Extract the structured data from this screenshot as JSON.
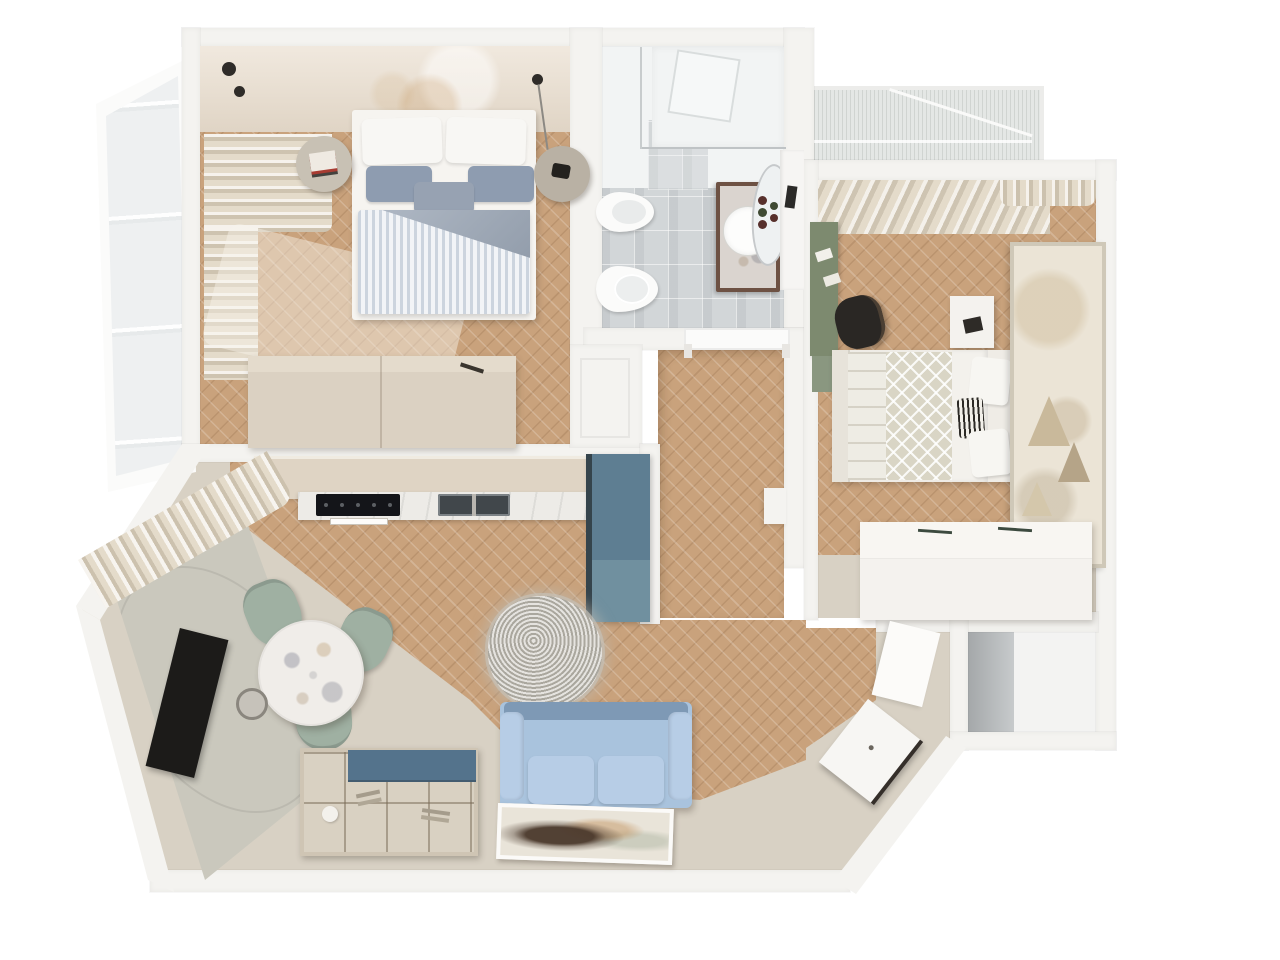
{
  "scene": {
    "type": "3d-floor-plan-render",
    "view": "top-down-isometric",
    "subject": "two-bedroom apartment interior visualization",
    "text_on_screen": "none"
  },
  "rooms": [
    {
      "id": "bedroom-1",
      "position": "top-left",
      "floor": "wood-herringbone",
      "furniture": [
        "double-bed-striped-duvet",
        "round-nightstand-left",
        "round-nightstand-right",
        "wardrobe",
        "curtains",
        "open-casement-window",
        "ceiling-spotlights"
      ]
    },
    {
      "id": "bathroom",
      "position": "top-center",
      "floor": "grey-tile",
      "furniture": [
        "shower-tray",
        "glass-partition",
        "bidet",
        "toilet",
        "wood-vanity-round-sink",
        "round-mirror",
        "shelf-unit"
      ]
    },
    {
      "id": "bedroom-2",
      "position": "right",
      "floor": "wood-herringbone",
      "furniture": [
        "single-bed",
        "green-desk",
        "black-chair",
        "white-nightstand",
        "wall-tapestry",
        "white-dresser",
        "curtains"
      ]
    },
    {
      "id": "balcony",
      "position": "top-right",
      "furniture": [
        "glass-balustrade"
      ]
    },
    {
      "id": "hallway",
      "position": "center",
      "floor": "wood-herringbone",
      "furniture": [
        "bathroom-door-frame"
      ]
    },
    {
      "id": "kitchen-living-room",
      "position": "bottom-left",
      "floor": "wood-and-beige",
      "furniture": [
        "kitchen-cabinet-run",
        "cooktop",
        "double-sink",
        "tall-blue-cabinet",
        "round-marble-dining-table",
        "sage-chairs",
        "pendant-lamp",
        "tv-accent-wall",
        "shag-rug",
        "blue-sofa",
        "compartment-organizer",
        "floor-painting",
        "curtains"
      ]
    },
    {
      "id": "entry",
      "position": "bottom-right",
      "furniture": [
        "open-front-door",
        "wall-panel"
      ]
    },
    {
      "id": "storage-closet",
      "position": "bottom-right-corner",
      "furniture": []
    }
  ],
  "palette": {
    "background": "#ffffff",
    "wall": "#f4f3f0",
    "wood_floor": "#c9a27c",
    "beige_floor": "#d8d1c4",
    "tile_floor": "#d2d6d8",
    "shower_white": "#f2f4f4",
    "headboard_wall": "#e9ddcd",
    "curtain": "#e4dbca",
    "sheer": "#f4efe6",
    "bed_linen": "#f6f4f0",
    "pillow_blue": "#8e9cb0",
    "duvet_fold": "#97a3b3",
    "duvet_stripe": "#dfe4eb",
    "nightstand": "#c8c1b4",
    "wardrobe": "#dbd1c2",
    "wardrobe_top": "#e4dbcc",
    "kitchen_cabinet": "#dfd4c4",
    "counter_marble": "#edebe7",
    "cooktop": "#141519",
    "sink": "#41474b",
    "blue_cabinet": "#5e7e92",
    "blue_cabinet_front": "#70909f",
    "blue_cabinet_edge": "#35444c",
    "accent_wall": "#cac8bd",
    "tv": "#1c1b19",
    "table_marble": "#f0ede9",
    "chair_sage": "#9fb0a2",
    "pendant": "#c6c2ba",
    "rug": "#c6c2b9",
    "sofa": "#a9c3dd",
    "sofa_cushion": "#b7cde6",
    "sofa_dark": "#7e99b5",
    "organizer": "#d9d1c2",
    "organizer_lid": "#54738c",
    "painting_bg": "#e9e4d9",
    "painting_subject": "#4a382b",
    "desk_green": "#7d8a6f",
    "desk_green_light": "#8a9780",
    "chair_black": "#2a2724",
    "bed2_base": "#efece6",
    "bed2_lattice": "#d9d5c5",
    "tapestry": "#ebe4d6",
    "tapestry_print": "#c9b99b",
    "dresser_white": "#f4f2ee",
    "vanity_wood": "#6d5143",
    "porcelain": "#fbfbfa",
    "mirror_glass": "#eef1f2",
    "glass": "#eef0f1",
    "balcony_glass": "#e4e7e5",
    "door_leaf": "#f7f6f3",
    "door_dark_edge": "#352f2a",
    "closet_wall_grey": "#b9bdbf",
    "closet_floor": "#f3f3f2",
    "spotlight": "#2f2c29"
  }
}
